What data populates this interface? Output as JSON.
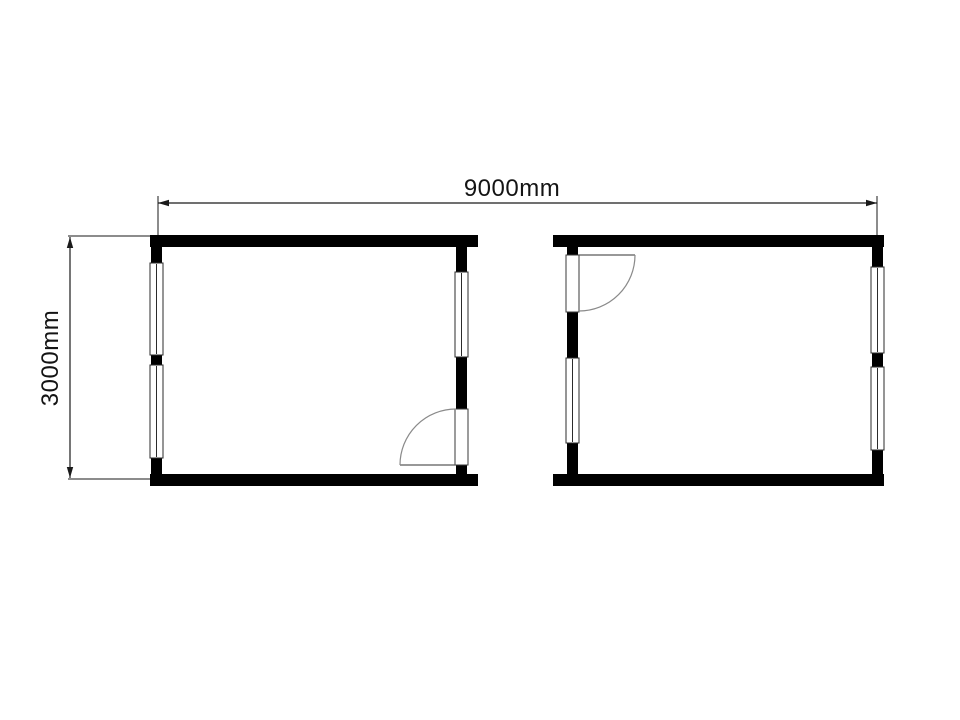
{
  "diagram": {
    "type": "floor-plan",
    "units": "mm",
    "background_color": "#ffffff"
  },
  "dimensions": {
    "width": {
      "label": "9000mm",
      "value": 9000,
      "unit": "mm"
    },
    "height": {
      "label": "3000mm",
      "value": 3000,
      "unit": "mm"
    }
  },
  "palette": {
    "wall": "#000000",
    "thin_line": "#1a1a1a",
    "window_outline": "#2b2b2b",
    "door_arc": "#8a8a8a",
    "window_fill": "#ffffff"
  },
  "rooms": [
    {
      "id": "left-unit",
      "position": "left",
      "windows": [
        "left-wall-upper",
        "left-wall-lower",
        "right-wall-upper"
      ],
      "door": {
        "wall": "right",
        "location": "bottom",
        "hinge": "bottom",
        "swing": "into-room-left"
      }
    },
    {
      "id": "right-unit",
      "position": "right",
      "windows": [
        "left-wall-lower",
        "right-wall-upper",
        "right-wall-lower"
      ],
      "door": {
        "wall": "left",
        "location": "top",
        "hinge": "top",
        "swing": "into-room-right"
      }
    }
  ]
}
